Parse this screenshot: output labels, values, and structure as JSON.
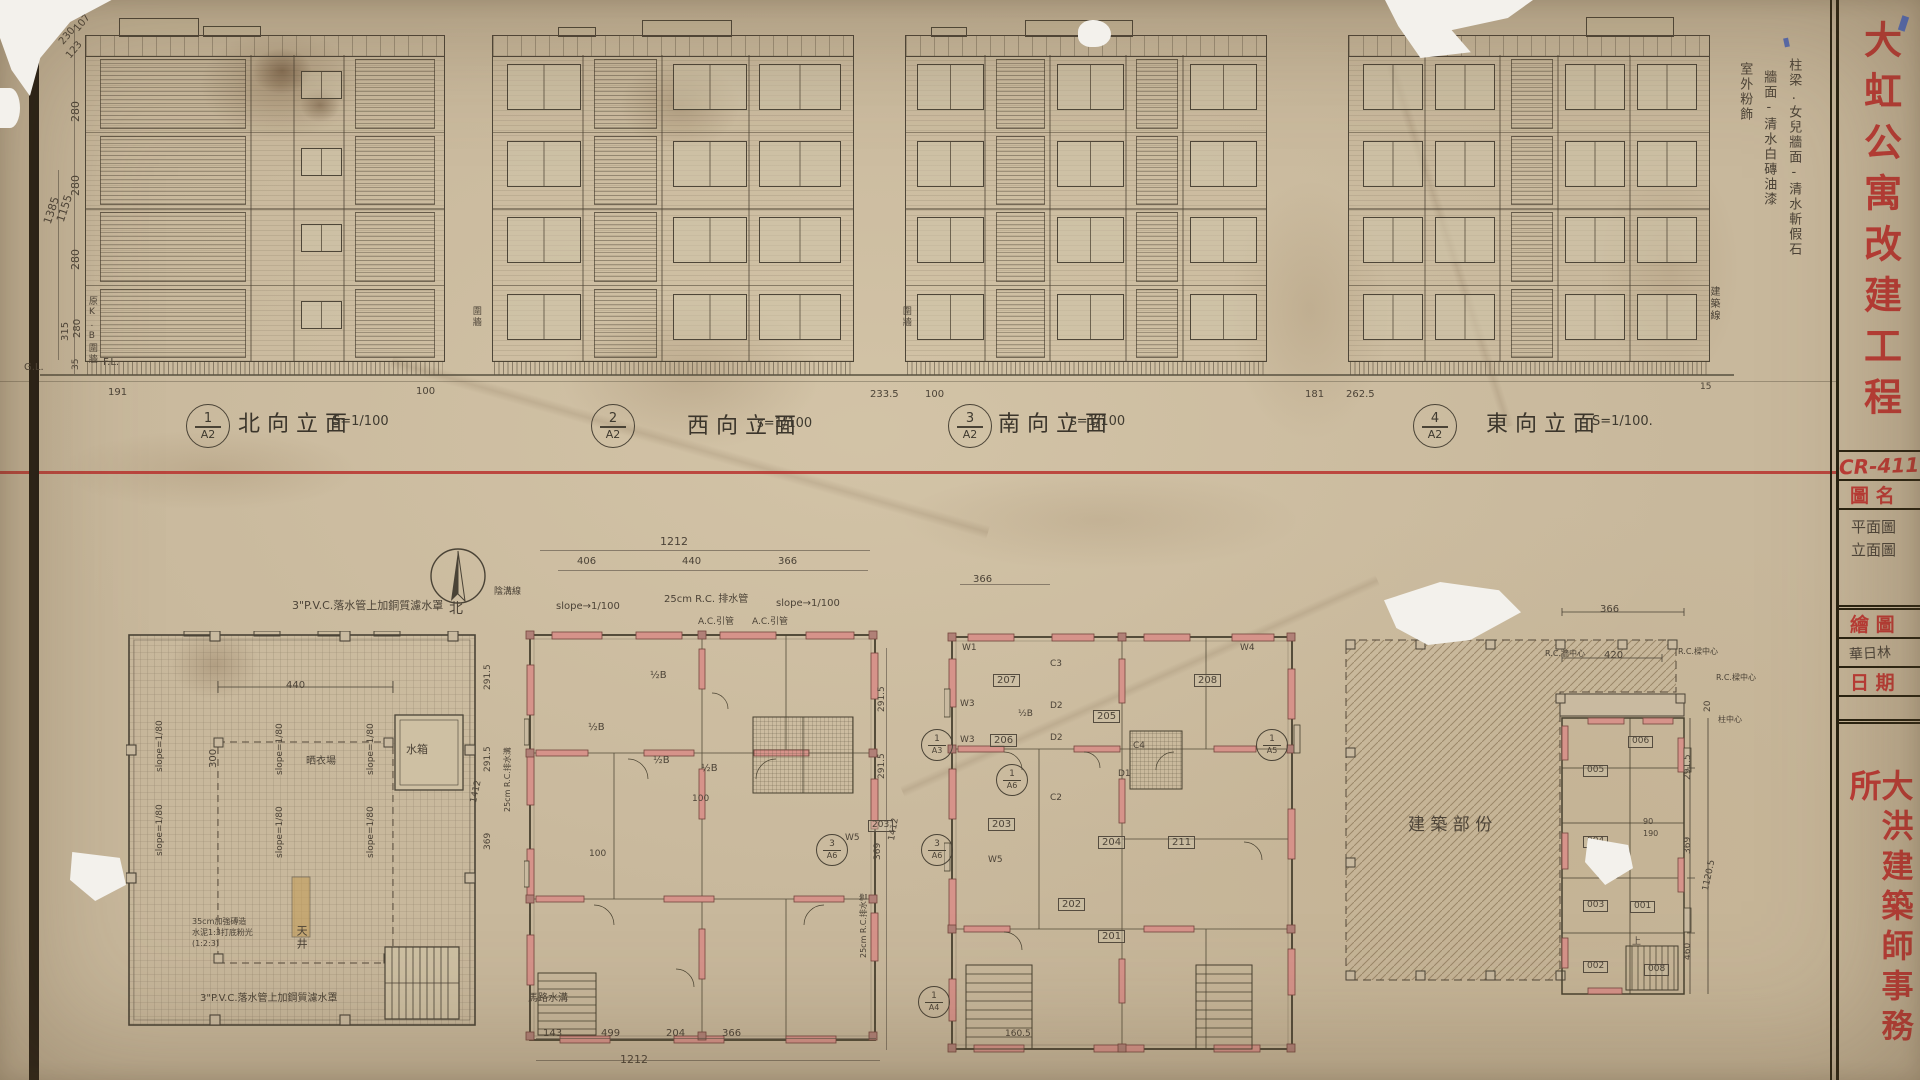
{
  "paper": {
    "red": "#bf3a35",
    "pencil": "#4c4337",
    "ink": "#26200f",
    "wall_red": "#d6938a"
  },
  "sheet": {
    "project_title": "大虹公寓改建工程",
    "sheet_no": "CR-411",
    "drawing_name_label": "圖 名",
    "drawing_name_line1": "平面圖",
    "drawing_name_line2": "立面圖",
    "drafter_label": "繪 圖",
    "drafter": "華日林",
    "date_label": "日 期",
    "firm": "大洪建築師事務所"
  },
  "elevations": [
    {
      "num": "1",
      "sheet": "A2",
      "title": "北向立面",
      "scale": "S=1/100"
    },
    {
      "num": "2",
      "sheet": "A2",
      "title": "西向立面",
      "scale": "s=1/100"
    },
    {
      "num": "3",
      "sheet": "A2",
      "title": "南向立面",
      "scale": "s=1/100"
    },
    {
      "num": "4",
      "sheet": "A2",
      "title": "東向立面",
      "scale": "S=1/100."
    }
  ],
  "section_marks": [
    {
      "a": "1",
      "b": "A3",
      "x": 921,
      "y": 729
    },
    {
      "a": "3",
      "b": "A6",
      "x": 816,
      "y": 834
    },
    {
      "a": "3",
      "b": "A6",
      "x": 921,
      "y": 834
    },
    {
      "a": "1",
      "b": "A6",
      "x": 996,
      "y": 764
    },
    {
      "a": "1",
      "b": "A5",
      "x": 1256,
      "y": 729
    },
    {
      "a": "1",
      "b": "A4",
      "x": 918,
      "y": 986
    }
  ],
  "labels": [
    {
      "n": "dim",
      "t": "230",
      "x": 57,
      "y": 40,
      "r": -50,
      "s": 10
    },
    {
      "n": "dim",
      "t": "107",
      "x": 72,
      "y": 27,
      "r": -50,
      "s": 10
    },
    {
      "n": "dim",
      "t": "123",
      "x": 64,
      "y": 54,
      "r": -50,
      "s": 10
    },
    {
      "n": "dim",
      "t": "280",
      "x": 70,
      "y": 122,
      "r": -90,
      "s": 11
    },
    {
      "n": "dim",
      "t": "280",
      "x": 70,
      "y": 196,
      "r": -90,
      "s": 11
    },
    {
      "n": "dim",
      "t": "280",
      "x": 70,
      "y": 270,
      "r": -90,
      "s": 11
    },
    {
      "n": "dim",
      "t": "1385",
      "x": 42,
      "y": 222,
      "r": -72,
      "s": 11
    },
    {
      "n": "dim",
      "t": "1155",
      "x": 55,
      "y": 220,
      "r": -72,
      "s": 11
    },
    {
      "n": "dim",
      "t": "315",
      "x": 60,
      "y": 341,
      "r": -90,
      "s": 10
    },
    {
      "n": "dim",
      "t": "280",
      "x": 72,
      "y": 338,
      "r": -90,
      "s": 10
    },
    {
      "n": "dim",
      "t": "35",
      "x": 72,
      "y": 370,
      "r": -90,
      "s": 9
    },
    {
      "n": "level-label",
      "t": "G.L.",
      "x": 24,
      "y": 362,
      "s": 10
    },
    {
      "n": "level-label",
      "t": "F.L.",
      "x": 103,
      "y": 357,
      "s": 10
    },
    {
      "n": "note",
      "t": "原K.B圍牆",
      "x": 86,
      "y": 296,
      "s": 9,
      "v": 1
    },
    {
      "n": "dim",
      "t": "191",
      "x": 108,
      "y": 387,
      "s": 10
    },
    {
      "n": "dim",
      "t": "100",
      "x": 416,
      "y": 386,
      "s": 10
    },
    {
      "n": "note",
      "t": "圍牆",
      "x": 470,
      "y": 306,
      "s": 9,
      "v": 1
    },
    {
      "n": "note",
      "t": "圍牆",
      "x": 900,
      "y": 306,
      "s": 9,
      "v": 1
    },
    {
      "n": "dim",
      "t": "233.5",
      "x": 870,
      "y": 389,
      "s": 10
    },
    {
      "n": "dim",
      "t": "100",
      "x": 925,
      "y": 389,
      "s": 10
    },
    {
      "n": "dim",
      "t": "181",
      "x": 1305,
      "y": 389,
      "s": 10
    },
    {
      "n": "dim",
      "t": "262.5",
      "x": 1346,
      "y": 389,
      "s": 10
    },
    {
      "n": "dim",
      "t": "15",
      "x": 1700,
      "y": 383,
      "s": 9
    },
    {
      "n": "note",
      "t": "建築線",
      "x": 1708,
      "y": 286,
      "s": 10,
      "v": 1
    },
    {
      "n": "finish-note",
      "t": "柱梁.女兒牆面-清水斬假石",
      "x": 1786,
      "y": 58,
      "s": 13,
      "v": 1
    },
    {
      "n": "finish-note",
      "t": "牆面-清水白磚油漆",
      "x": 1761,
      "y": 70,
      "s": 13,
      "v": 1
    },
    {
      "n": "finish-note",
      "t": "室外粉飾",
      "x": 1737,
      "y": 62,
      "s": 13,
      "v": 1
    },
    {
      "n": "note",
      "t": "3\"P.V.C.落水管上加銅質濾水罩",
      "x": 292,
      "y": 600,
      "s": 11
    },
    {
      "n": "slope-note",
      "t": "slope=1/80",
      "x": 156,
      "y": 772,
      "r": -90,
      "s": 9
    },
    {
      "n": "slope-note",
      "t": "slope=1/80",
      "x": 276,
      "y": 775,
      "r": -90,
      "s": 9
    },
    {
      "n": "slope-note",
      "t": "slope=1/80",
      "x": 367,
      "y": 775,
      "r": -90,
      "s": 9
    },
    {
      "n": "slope-note",
      "t": "slope=1/80",
      "x": 156,
      "y": 856,
      "r": -90,
      "s": 9
    },
    {
      "n": "slope-note",
      "t": "slope=1/80",
      "x": 276,
      "y": 858,
      "r": -90,
      "s": 9
    },
    {
      "n": "slope-note",
      "t": "slope=1/80",
      "x": 367,
      "y": 858,
      "r": -90,
      "s": 9
    },
    {
      "n": "dim",
      "t": "440",
      "x": 286,
      "y": 680,
      "s": 10
    },
    {
      "n": "dim",
      "t": "300",
      "x": 208,
      "y": 768,
      "r": -90,
      "s": 10
    },
    {
      "n": "room-label",
      "t": "水箱",
      "x": 406,
      "y": 744,
      "s": 11
    },
    {
      "n": "room-label",
      "t": "天井",
      "x": 295,
      "y": 925,
      "s": 11,
      "v": 1
    },
    {
      "n": "room-label",
      "t": "晒衣場",
      "x": 306,
      "y": 756,
      "s": 10
    },
    {
      "n": "note",
      "t": "35cm加強磚造",
      "x": 192,
      "y": 918,
      "s": 8
    },
    {
      "n": "note",
      "t": "水泥1:3打底粉光",
      "x": 192,
      "y": 929,
      "s": 8
    },
    {
      "n": "note",
      "t": "(1:2:3)",
      "x": 192,
      "y": 940,
      "s": 8
    },
    {
      "n": "note",
      "t": "3\"P.V.C.落水管上加鋼質濾水罩",
      "x": 200,
      "y": 993,
      "s": 10
    },
    {
      "n": "north-label",
      "t": "北",
      "x": 449,
      "y": 602,
      "s": 14
    },
    {
      "n": "dim",
      "t": "1212",
      "x": 660,
      "y": 536,
      "s": 11
    },
    {
      "n": "dim",
      "t": "406",
      "x": 577,
      "y": 556,
      "s": 10
    },
    {
      "n": "dim",
      "t": "440",
      "x": 682,
      "y": 556,
      "s": 10
    },
    {
      "n": "dim",
      "t": "366",
      "x": 778,
      "y": 556,
      "s": 10
    },
    {
      "n": "note",
      "t": "陰溝線",
      "x": 494,
      "y": 588,
      "s": 9
    },
    {
      "n": "slope-note",
      "t": "slope→1/100",
      "x": 556,
      "y": 601,
      "s": 10
    },
    {
      "n": "note",
      "t": "25cm R.C. 排水管",
      "x": 664,
      "y": 594,
      "s": 10
    },
    {
      "n": "note",
      "t": "A.C.引管",
      "x": 698,
      "y": 618,
      "s": 9
    },
    {
      "n": "slope-note",
      "t": "slope→1/100",
      "x": 776,
      "y": 598,
      "s": 10
    },
    {
      "n": "note",
      "t": "A.C.引管",
      "x": 752,
      "y": 618,
      "s": 9
    },
    {
      "n": "room-label",
      "t": "½B",
      "x": 650,
      "y": 670,
      "s": 10
    },
    {
      "n": "room-label",
      "t": "½B",
      "x": 588,
      "y": 722,
      "s": 10
    },
    {
      "n": "room-label",
      "t": "½B",
      "x": 653,
      "y": 755,
      "s": 10
    },
    {
      "n": "room-label",
      "t": "½B",
      "x": 701,
      "y": 763,
      "s": 10
    },
    {
      "n": "dim",
      "t": "291.5",
      "x": 484,
      "y": 690,
      "r": -90,
      "s": 9
    },
    {
      "n": "dim",
      "t": "291.5",
      "x": 484,
      "y": 772,
      "r": -90,
      "s": 9
    },
    {
      "n": "dim",
      "t": "1412",
      "x": 470,
      "y": 802,
      "r": -78,
      "s": 9
    },
    {
      "n": "dim",
      "t": "369",
      "x": 484,
      "y": 850,
      "r": -90,
      "s": 9
    },
    {
      "n": "note",
      "t": "25cm R.C.排水溝",
      "x": 504,
      "y": 812,
      "r": -90,
      "s": 8
    },
    {
      "n": "dim",
      "t": "100",
      "x": 692,
      "y": 795,
      "s": 9
    },
    {
      "n": "dim",
      "t": "100",
      "x": 589,
      "y": 850,
      "s": 9
    },
    {
      "n": "note",
      "t": "馬路水溝",
      "x": 528,
      "y": 993,
      "s": 10
    },
    {
      "n": "dim",
      "t": "143",
      "x": 543,
      "y": 1028,
      "s": 10
    },
    {
      "n": "dim",
      "t": "499",
      "x": 601,
      "y": 1028,
      "s": 10
    },
    {
      "n": "dim",
      "t": "204",
      "x": 666,
      "y": 1028,
      "s": 10
    },
    {
      "n": "dim",
      "t": "366",
      "x": 722,
      "y": 1028,
      "s": 10
    },
    {
      "n": "dim",
      "t": "1212",
      "x": 620,
      "y": 1054,
      "s": 11
    },
    {
      "n": "dim",
      "t": "291.5",
      "x": 878,
      "y": 712,
      "r": -90,
      "s": 9
    },
    {
      "n": "dim",
      "t": "291.5",
      "x": 878,
      "y": 779,
      "r": -90,
      "s": 9
    },
    {
      "n": "dim",
      "t": "1412",
      "x": 888,
      "y": 840,
      "r": -80,
      "s": 9
    },
    {
      "n": "dim",
      "t": "369",
      "x": 874,
      "y": 860,
      "r": -90,
      "s": 9
    },
    {
      "n": "note",
      "t": "25cm R.C.排水管",
      "x": 860,
      "y": 958,
      "r": -90,
      "s": 8
    },
    {
      "n": "room-number",
      "t": "207",
      "x": 993,
      "y": 674,
      "s": 10,
      "b": 1
    },
    {
      "n": "room-number",
      "t": "208",
      "x": 1194,
      "y": 674,
      "s": 10,
      "b": 1
    },
    {
      "n": "room-number",
      "t": "206",
      "x": 990,
      "y": 734,
      "s": 10,
      "b": 1
    },
    {
      "n": "room-number",
      "t": "205",
      "x": 1093,
      "y": 710,
      "s": 10,
      "b": 1
    },
    {
      "n": "room-number",
      "t": "203",
      "x": 988,
      "y": 818,
      "s": 10,
      "b": 1
    },
    {
      "n": "room-number",
      "t": "204",
      "x": 1098,
      "y": 836,
      "s": 10,
      "b": 1
    },
    {
      "n": "room-number",
      "t": "211",
      "x": 1168,
      "y": 836,
      "s": 10,
      "b": 1
    },
    {
      "n": "room-number",
      "t": "202",
      "x": 1058,
      "y": 898,
      "s": 10,
      "b": 1
    },
    {
      "n": "room-number",
      "t": "201",
      "x": 1098,
      "y": 930,
      "s": 10,
      "b": 1
    },
    {
      "n": "room-number",
      "t": "203",
      "x": 868,
      "y": 820,
      "s": 9,
      "b": 1
    },
    {
      "n": "room-label",
      "t": "½B",
      "x": 1018,
      "y": 710,
      "s": 9
    },
    {
      "n": "wall-tag",
      "t": "W1",
      "x": 962,
      "y": 644,
      "s": 9
    },
    {
      "n": "wall-tag",
      "t": "W3",
      "x": 960,
      "y": 700,
      "s": 9
    },
    {
      "n": "wall-tag",
      "t": "W3",
      "x": 960,
      "y": 736,
      "s": 9
    },
    {
      "n": "wall-tag",
      "t": "W5",
      "x": 845,
      "y": 834,
      "s": 9
    },
    {
      "n": "wall-tag",
      "t": "W5",
      "x": 988,
      "y": 856,
      "s": 9
    },
    {
      "n": "wall-tag",
      "t": "C3",
      "x": 1050,
      "y": 660,
      "s": 9
    },
    {
      "n": "wall-tag",
      "t": "D2",
      "x": 1050,
      "y": 702,
      "s": 9
    },
    {
      "n": "wall-tag",
      "t": "D2",
      "x": 1050,
      "y": 734,
      "s": 9
    },
    {
      "n": "wall-tag",
      "t": "C2",
      "x": 1050,
      "y": 794,
      "s": 9
    },
    {
      "n": "wall-tag",
      "t": "C4",
      "x": 1133,
      "y": 742,
      "s": 9
    },
    {
      "n": "wall-tag",
      "t": "D1",
      "x": 1118,
      "y": 770,
      "s": 9
    },
    {
      "n": "wall-tag",
      "t": "W4",
      "x": 1240,
      "y": 644,
      "s": 9
    },
    {
      "n": "dim",
      "t": "366",
      "x": 973,
      "y": 574,
      "s": 10
    },
    {
      "n": "dim",
      "t": "160.5",
      "x": 1005,
      "y": 1030,
      "s": 9
    },
    {
      "n": "area-label",
      "t": "建 築 部 份",
      "x": 1408,
      "y": 816,
      "s": 17
    },
    {
      "n": "dim",
      "t": "366",
      "x": 1600,
      "y": 604,
      "s": 10
    },
    {
      "n": "note",
      "t": "R.C.牆中心",
      "x": 1545,
      "y": 650,
      "s": 8
    },
    {
      "n": "dim",
      "t": "420",
      "x": 1604,
      "y": 650,
      "s": 10
    },
    {
      "n": "note",
      "t": "R.C.樑中心",
      "x": 1678,
      "y": 648,
      "s": 8
    },
    {
      "n": "note",
      "t": "R.C.樑中心",
      "x": 1716,
      "y": 674,
      "s": 8
    },
    {
      "n": "note",
      "t": "柱中心",
      "x": 1718,
      "y": 716,
      "s": 8
    },
    {
      "n": "dim",
      "t": "20",
      "x": 1704,
      "y": 712,
      "r": -90,
      "s": 9
    },
    {
      "n": "dim",
      "t": "291.5",
      "x": 1684,
      "y": 780,
      "r": -90,
      "s": 9
    },
    {
      "n": "dim",
      "t": "90",
      "x": 1643,
      "y": 818,
      "s": 8
    },
    {
      "n": "dim",
      "t": "190",
      "x": 1643,
      "y": 830,
      "s": 8
    },
    {
      "n": "dim",
      "t": "369",
      "x": 1684,
      "y": 854,
      "r": -90,
      "s": 9
    },
    {
      "n": "dim",
      "t": "1120.5",
      "x": 1702,
      "y": 890,
      "r": -78,
      "s": 9
    },
    {
      "n": "dim",
      "t": "460",
      "x": 1684,
      "y": 960,
      "r": -90,
      "s": 9
    },
    {
      "n": "room-number",
      "t": "006",
      "x": 1628,
      "y": 736,
      "s": 9,
      "b": 1
    },
    {
      "n": "room-number",
      "t": "005",
      "x": 1583,
      "y": 765,
      "s": 9,
      "b": 1
    },
    {
      "n": "room-number",
      "t": "004",
      "x": 1583,
      "y": 836,
      "s": 9,
      "b": 1
    },
    {
      "n": "room-number",
      "t": "003",
      "x": 1583,
      "y": 900,
      "s": 9,
      "b": 1
    },
    {
      "n": "room-number",
      "t": "001",
      "x": 1630,
      "y": 901,
      "s": 9,
      "b": 1
    },
    {
      "n": "room-number",
      "t": "002",
      "x": 1583,
      "y": 961,
      "s": 9,
      "b": 1
    },
    {
      "n": "room-number",
      "t": "008",
      "x": 1644,
      "y": 964,
      "s": 9,
      "b": 1
    },
    {
      "n": "note",
      "t": "上",
      "x": 1632,
      "y": 938,
      "s": 9
    }
  ]
}
